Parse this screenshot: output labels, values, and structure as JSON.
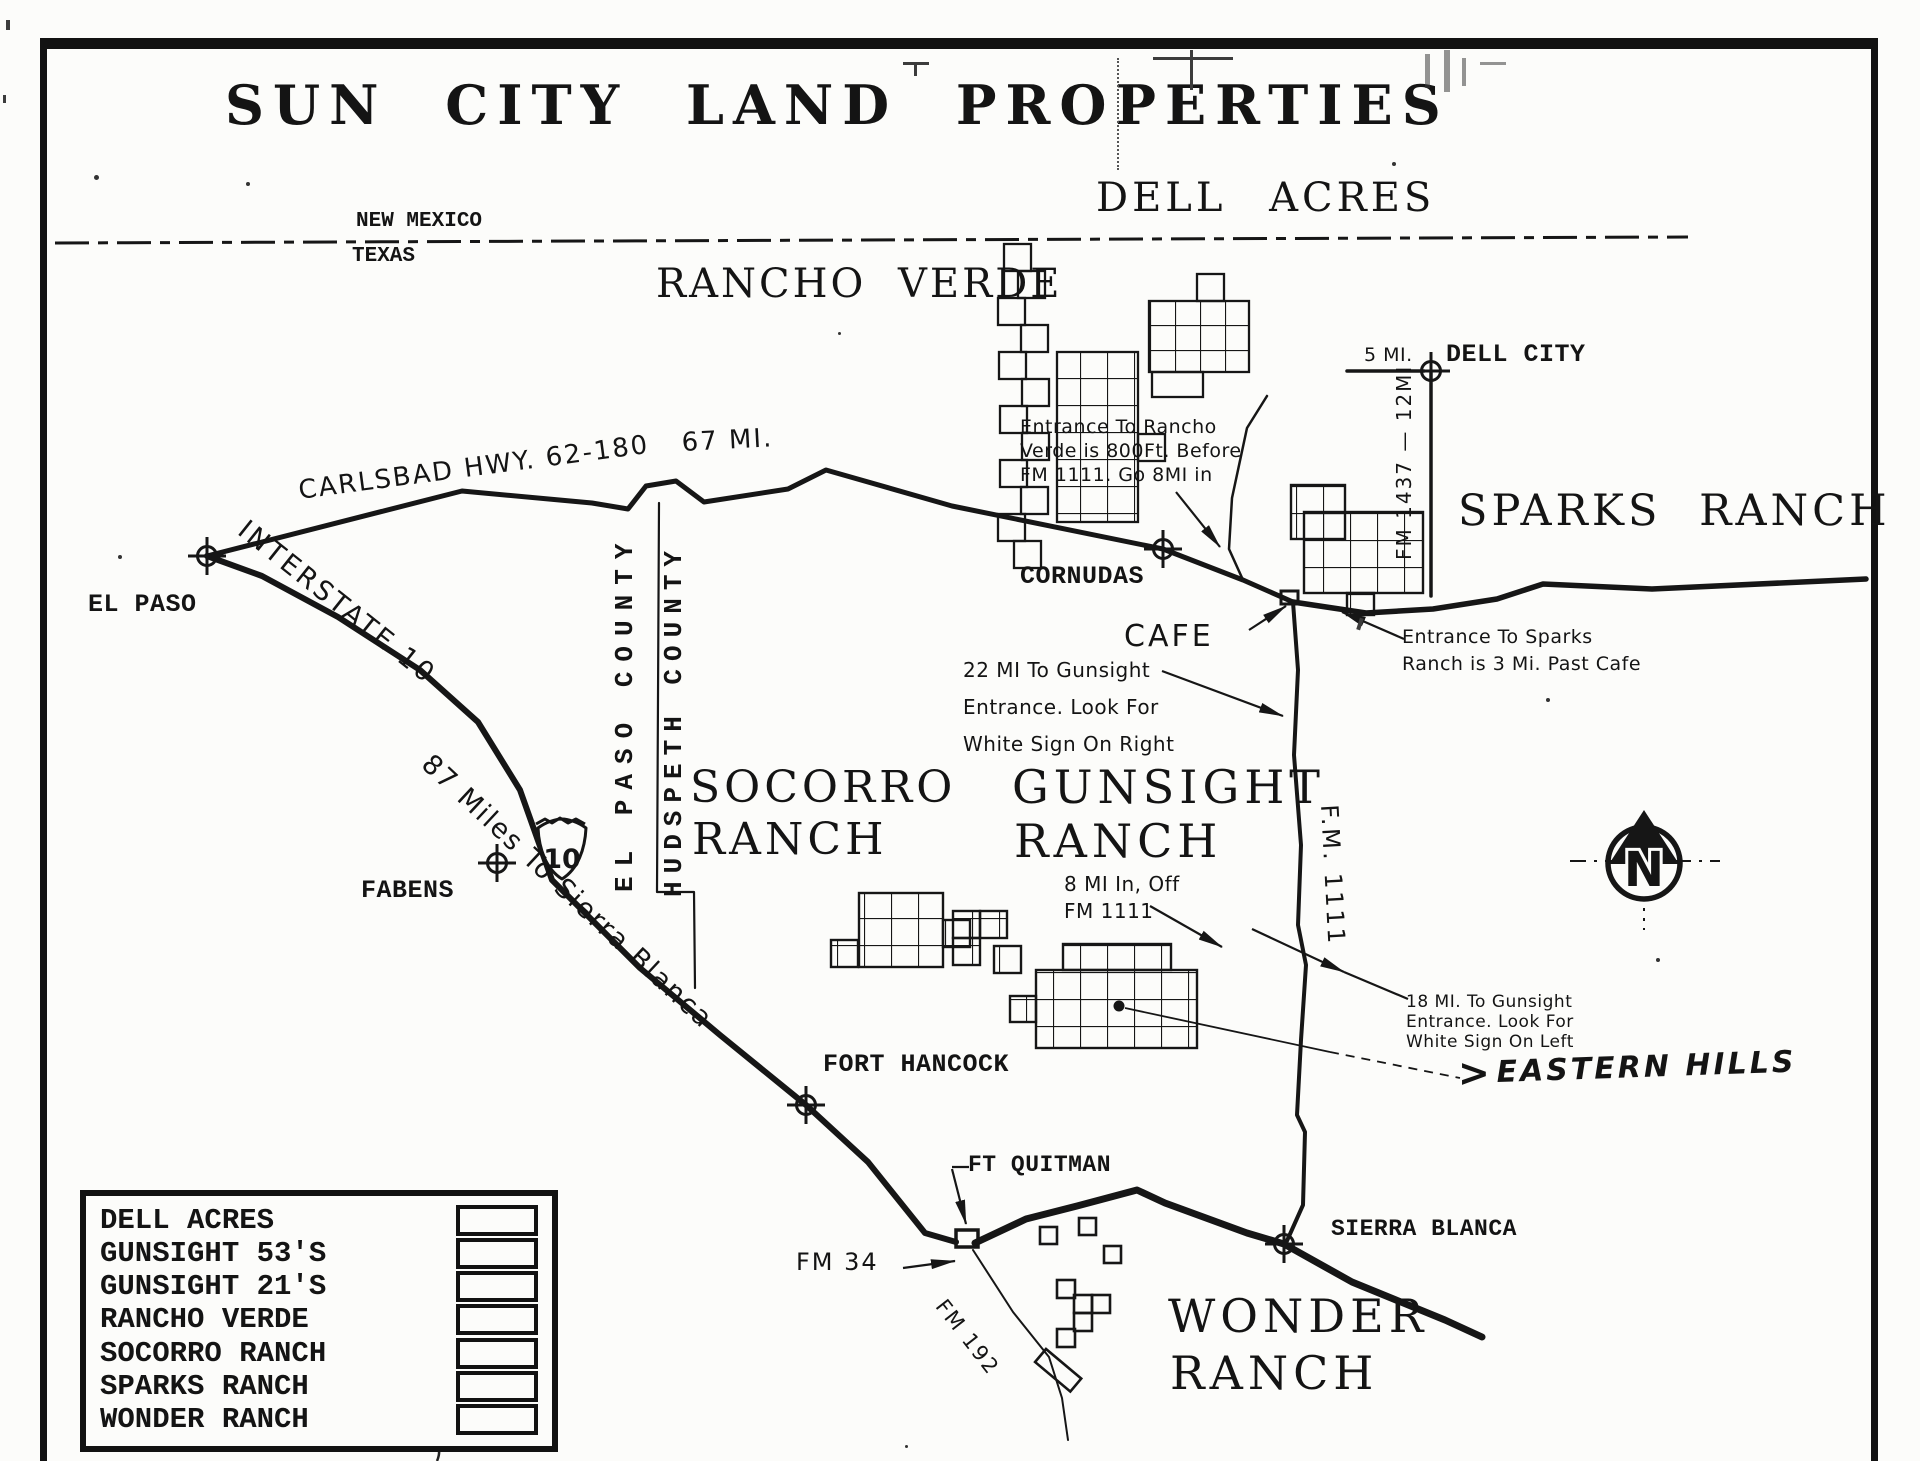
{
  "title": "SUN CITY LAND PROPERTIES",
  "state_line": {
    "top": "NEW MEXICO",
    "bottom": "TEXAS"
  },
  "areas": {
    "dell_acres": "DELL ACRES",
    "rancho_verde": "RANCHO VERDE",
    "sparks_ranch": "SPARKS RANCH",
    "socorro_line1": "SOCORRO",
    "socorro_line2": "RANCH",
    "gunsight_line1": "GUNSIGHT",
    "gunsight_line2": "RANCH",
    "wonder_line1": "WONDER",
    "wonder_line2": "RANCH"
  },
  "towns": {
    "el_paso": "EL PASO",
    "fabens": "FABENS",
    "cornudas": "CORNUDAS",
    "dell_city": "DELL CITY",
    "fort_hancock": "FORT HANCOCK",
    "ft_quitman": "FT QUITMAN",
    "sierra_blanca": "SIERRA BLANCA",
    "cafe": "CAFE"
  },
  "roads": {
    "carlsbad_hwy": "CARLSBAD HWY. 62-180",
    "carlsbad_miles": "67 MI.",
    "interstate_10": "INTERSTATE 10",
    "i10_shield": "10",
    "i10_miles": "87 Miles To Sierra Blanca",
    "fm_1111": "F.M. 1111",
    "fm_1437": "FM 1437 — 12MI",
    "fm_34": "FM 34",
    "fm_192": "FM 192",
    "dell_city_miles": "5 MI.",
    "county_west": "EL PASO COUNTY",
    "county_east": "HUDSPETH COUNTY"
  },
  "notes": {
    "rancho_verde": [
      "Entrance To Rancho",
      "Verde is 800Ft. Before",
      "FM 1111. Go 8MI in"
    ],
    "sparks": [
      "Entrance To Sparks",
      "Ranch is 3 Mi. Past Cafe"
    ],
    "gunsight_22": [
      "22 MI To Gunsight",
      "Entrance. Look For",
      "White Sign On Right"
    ],
    "gunsight_8": [
      "8 MI In, Off",
      "FM 1111"
    ],
    "gunsight_18": [
      "18 MI. To Gunsight",
      "Entrance.  Look For",
      "White Sign On Left"
    ],
    "eastern_hills_prefix": ">",
    "eastern_hills": "EASTERN HILLS"
  },
  "compass": {
    "north": "N"
  },
  "legend": {
    "items": [
      "DELL ACRES",
      "GUNSIGHT 53'S",
      "GUNSIGHT 21'S",
      "RANCHO VERDE",
      "SOCORRO RANCH",
      "SPARKS RANCH",
      "WONDER RANCH"
    ]
  }
}
